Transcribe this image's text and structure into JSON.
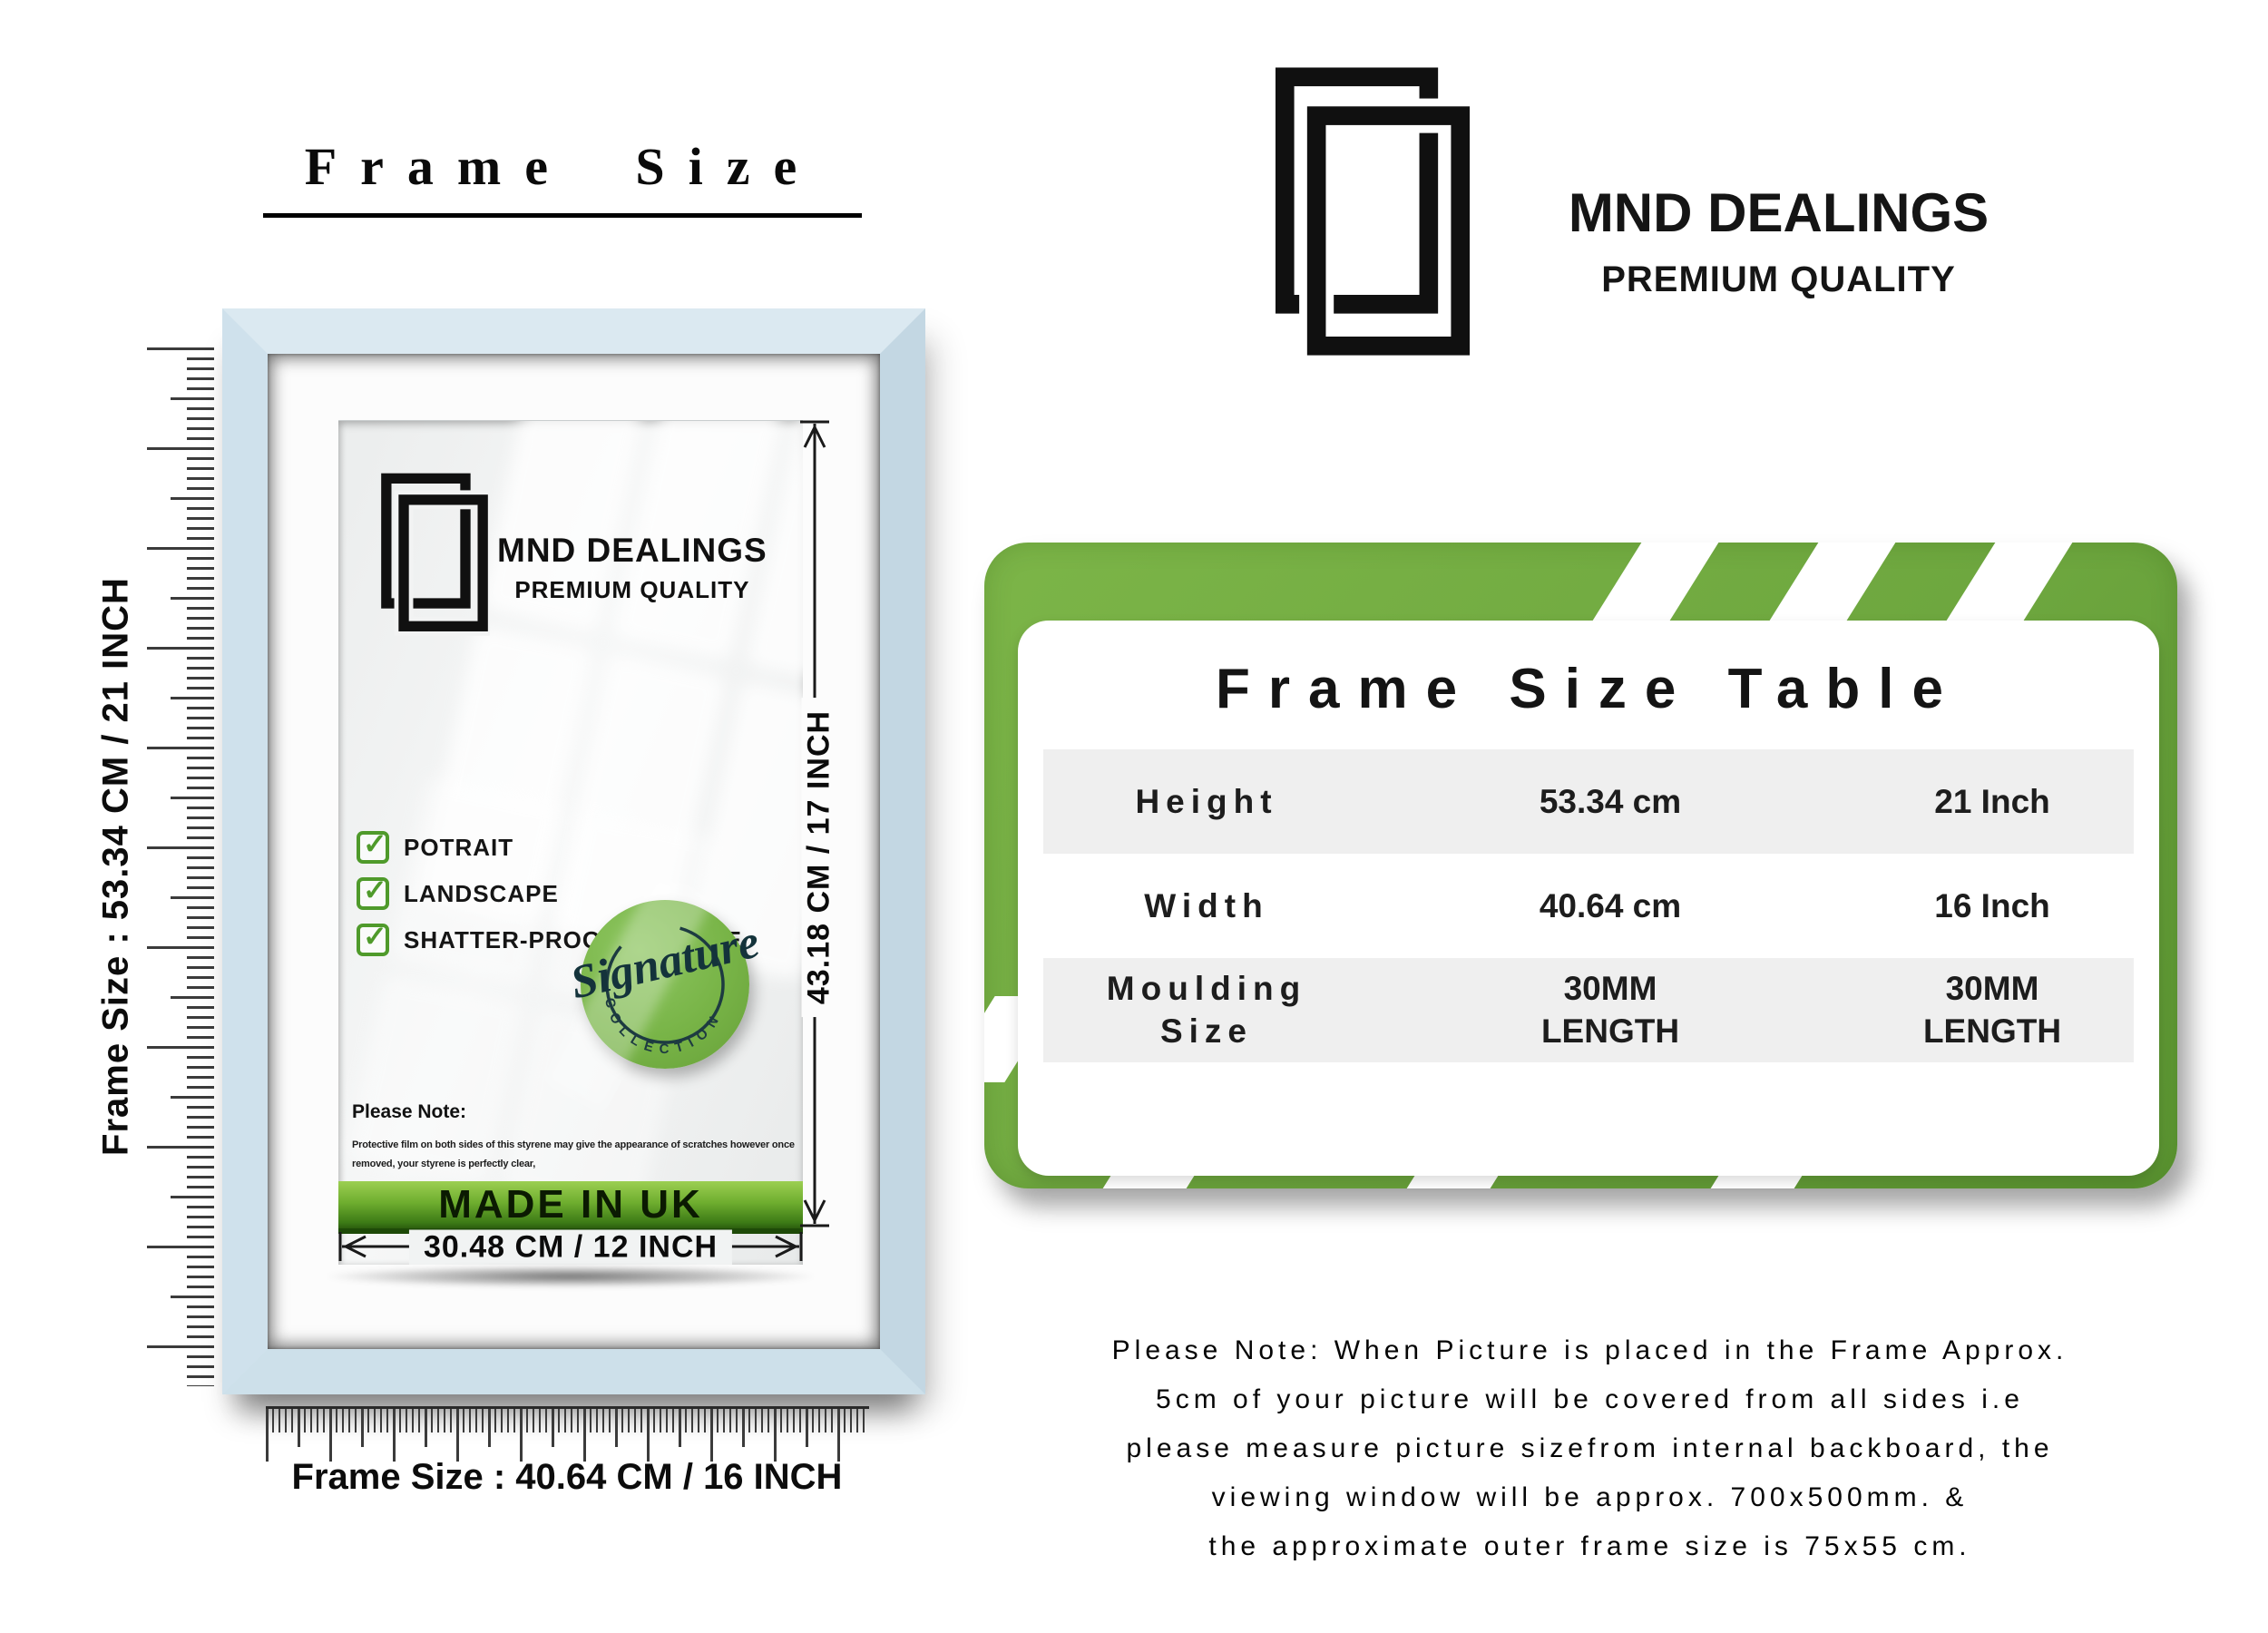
{
  "icons": {
    "check_glyph": "✓",
    "brand_logo": "overlapping-frames-icon"
  },
  "colors": {
    "frame_blue": "#cfe0ea",
    "banner_green": "#6fae2f",
    "card_green": "#6da63e",
    "badge_green": "#7bb84d",
    "check_green": "#4f9a2b",
    "table_row_gray": "#efefef",
    "ink": "#111111"
  },
  "left": {
    "title": "Frame Size",
    "vertical_ruler_label": "Frame Size : 53.34 CM / 21 INCH",
    "horizontal_ruler_label": "Frame Size : 40.64 CM / 16 INCH",
    "frame": {
      "brand": "MND DEALINGS",
      "tagline": "PREMIUM QUALITY",
      "features": [
        "POTRAIT",
        "LANDSCAPE",
        "SHATTER-PROOF STYRENE"
      ],
      "badge_script": "Signature",
      "badge_arc": "C O L L E C T I O N",
      "note_title": "Please Note:",
      "note_lines": [
        "Protective film on both sides of this styrene may give the appearance of scratches however once",
        "removed, your styrene is perfectly clear,"
      ],
      "banner": "MADE IN UK",
      "width_dim": "30.48 CM / 12 INCH",
      "height_dim": "43.18 CM / 17 INCH"
    }
  },
  "brand": {
    "name": "MND DEALINGS",
    "tagline": "PREMIUM QUALITY"
  },
  "table": {
    "title": "Frame Size Table",
    "rows": [
      {
        "label": "Height",
        "cm": "53.34 cm",
        "inch": "21 Inch"
      },
      {
        "label": "Width",
        "cm": "40.64 cm",
        "inch": "16 Inch"
      },
      {
        "label": "Moulding Size",
        "cm": "30MM LENGTH",
        "inch": "30MM LENGTH"
      }
    ]
  },
  "note": {
    "lines": [
      "Please Note: When Picture is placed in the Frame Approx.",
      "5cm of your picture will be covered from all sides i.e",
      "please measure picture sizefrom internal backboard, the",
      "viewing window will be approx. 700x500mm. &",
      "the approximate outer frame size is 75x55 cm."
    ]
  }
}
